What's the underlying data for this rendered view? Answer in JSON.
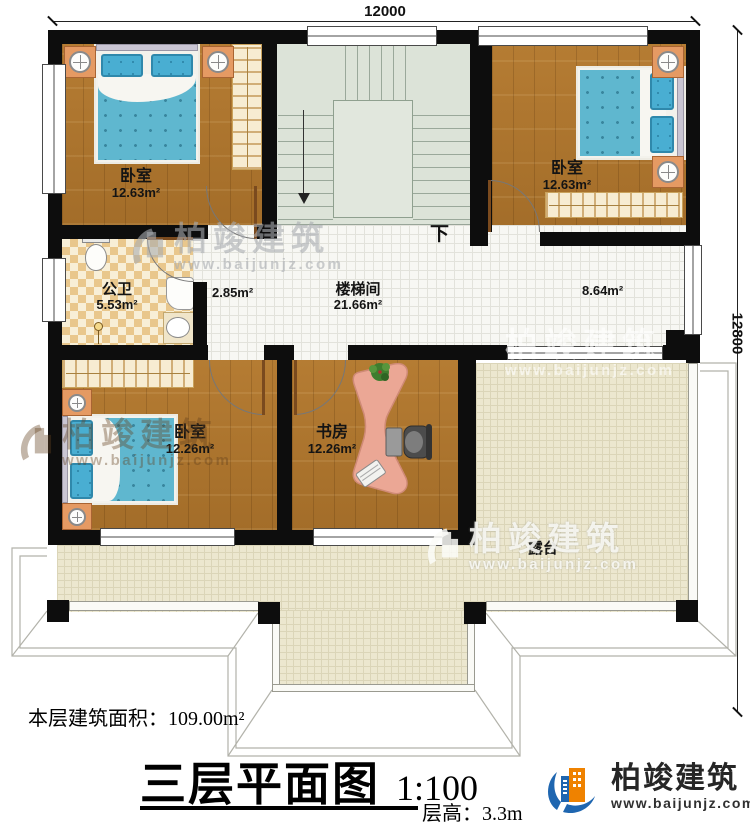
{
  "dimensions": {
    "width_top": "12000",
    "height_right": "12800"
  },
  "rooms": {
    "bedroom_nw": {
      "name": "卧室",
      "area": "12.63m²"
    },
    "bedroom_ne": {
      "name": "卧室",
      "area": "12.63m²"
    },
    "bathroom": {
      "name": "公卫",
      "area": "5.53m²"
    },
    "stairwell": {
      "name": "楼梯间",
      "area": "21.66m²"
    },
    "hall_west": {
      "area": "2.85m²"
    },
    "hall_east": {
      "area": "8.64m²"
    },
    "bedroom_sw": {
      "name": "卧室",
      "area": "12.26m²"
    },
    "study": {
      "name": "书房",
      "area": "12.26m²"
    },
    "terrace": {
      "name": "露台"
    }
  },
  "stairs": {
    "down_label": "下"
  },
  "footer": {
    "floor_area_label": "本层建筑面积：109.00m²",
    "plan_title": "三层平面图",
    "scale": "1:100",
    "floor_height": "层高：3.3m"
  },
  "brand": {
    "name": "柏竣建筑",
    "website": "www.baijunjz.com"
  },
  "colors": {
    "wall": "#0d0d0d",
    "wood_floor": "#ae752e",
    "bed_blue": "#5fb7cf",
    "brand_blue": "#1f66b0",
    "brand_orange": "#ef8200"
  }
}
